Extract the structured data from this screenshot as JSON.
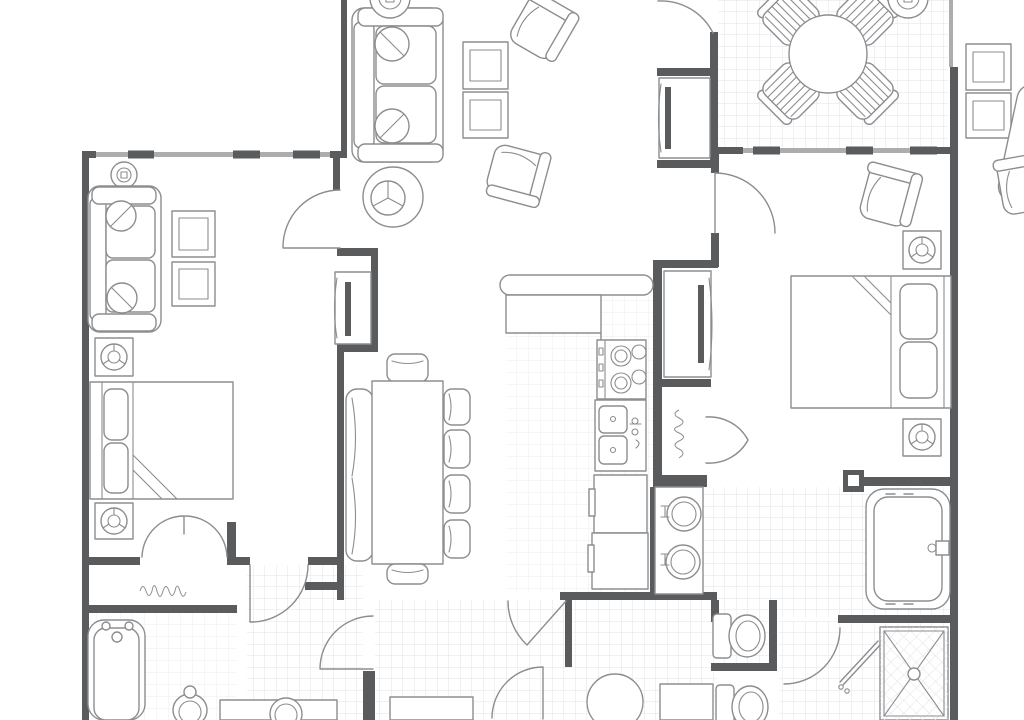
{
  "document": {
    "type": "architectural floor plan drawing",
    "canvas": {
      "width": 1024,
      "height": 720
    },
    "visible_text": []
  },
  "theme": {
    "wall": "#595b5d",
    "line": "#8b8d90",
    "window_band": "#abadaf",
    "tile": "#e2e3e5",
    "tile_light": "#ededef",
    "background": "#ffffff"
  },
  "annotations": [
    {
      "id": "laundry-closet-note",
      "text": "",
      "appearance": "illegible handwritten scribble, horizontal, inside closet below left bedroom"
    },
    {
      "id": "utility-closet-note",
      "text": "",
      "appearance": "illegible handwritten scribble, vertical, inside closet beside kitchen"
    }
  ],
  "rooms": [
    {
      "name": "living-area",
      "floor": "wood/plain",
      "furniture": [
        "sofa",
        "armchair",
        "armchair",
        "round-lamp-table",
        "nesting-table",
        "nesting-table",
        "tv-console",
        "ceiling-speaker"
      ]
    },
    {
      "name": "dining-area",
      "floor": "tile",
      "furniture": [
        "round-table",
        "chair",
        "chair",
        "chair",
        "chair",
        "ceiling-speaker"
      ]
    },
    {
      "name": "bedroom-left",
      "floor": "plain",
      "furniture": [
        "loveseat",
        "wall-frame",
        "wall-frame",
        "bed",
        "speaker-panel",
        "speaker-panel",
        "tv-console",
        "bifold-closet",
        "linen-closet",
        "wall-speaker"
      ]
    },
    {
      "name": "great-room-table",
      "floor": "plain",
      "furniture": [
        "long-dining-table",
        "bench",
        "chair",
        "chair",
        "chair",
        "chair",
        "chair",
        "chair"
      ]
    },
    {
      "name": "kitchen",
      "floor": "tile",
      "furniture": [
        "breakfast-bar",
        "cooktop",
        "double-sink",
        "refrigerator",
        "cabinet",
        "bifold-pantry"
      ]
    },
    {
      "name": "bedroom-right",
      "floor": "plain",
      "furniture": [
        "bed",
        "armchair",
        "speaker-panel",
        "speaker-panel",
        "tv-console"
      ]
    },
    {
      "name": "master-bath",
      "floor": "tile",
      "furniture": [
        "double-vanity",
        "jetted-tub",
        "toilet",
        "toilet",
        "shower-stall",
        "glass-door"
      ]
    },
    {
      "name": "bath-left",
      "floor": "tile",
      "furniture": [
        "bathtub",
        "toilet",
        "vanity-sink"
      ]
    },
    {
      "name": "foyer",
      "floor": "tile",
      "furniture": [
        "round-table",
        "console",
        "bench"
      ]
    }
  ]
}
